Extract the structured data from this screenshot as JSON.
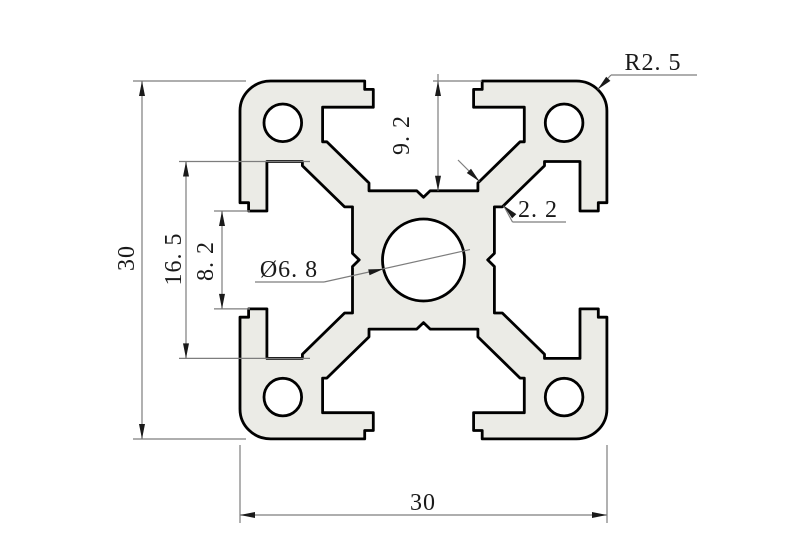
{
  "drawing": {
    "title": "aluminum extrusion profile cross-section",
    "labels": {
      "overall_height": "30",
      "overall_width": "30",
      "slot_inner_width": "16. 5",
      "slot_opening": "8. 2",
      "slot_depth": "9. 2",
      "web_thickness": "2. 2",
      "center_hole": "Ø6. 8",
      "corner_radius": "R2. 5"
    },
    "values_mm": {
      "overall_width": 30,
      "overall_height": 30,
      "slot_inner_width": 16.5,
      "slot_opening_width": 8.2,
      "slot_depth": 9.2,
      "web_thickness": 2.2,
      "center_hole_diameter": 6.8,
      "corner_radius": 2.5
    },
    "colors": {
      "outline": "#000000",
      "profile_fill": "#ebebe6",
      "dimension_lines": "#7d7d7d",
      "text": "#1a1a1a",
      "background": "#ffffff"
    }
  }
}
